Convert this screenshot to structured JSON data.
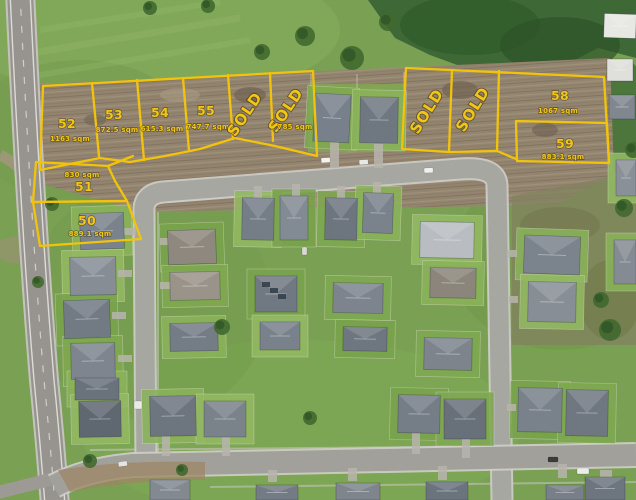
{
  "map": {
    "type": "aerial-subdivision-lot-map",
    "palette": {
      "lot_line": "#F2C30B",
      "lot_text": "#F2C614",
      "grass": "#7AA054",
      "dirt": "#93846F",
      "road": "#A7A7A2",
      "roof": "#78818B"
    },
    "lots": [
      {
        "number": "50",
        "area": "889.1 sqm"
      },
      {
        "number": "51",
        "area": "830 sqm"
      },
      {
        "number": "52",
        "area": "1163 sqm"
      },
      {
        "number": "53",
        "area": "872.5 sqm"
      },
      {
        "number": "54",
        "area": "615.3 sqm"
      },
      {
        "number": "55",
        "area": "747.7 sqm"
      },
      {
        "number": "58",
        "area": "1067 sqm"
      },
      {
        "number": "59",
        "area": "883.1 sqm"
      }
    ],
    "sold_lots": [
      {
        "label": "SOLD"
      },
      {
        "label": "SOLD",
        "area": "785 sqm"
      },
      {
        "label": "SOLD"
      },
      {
        "label": "SOLD"
      }
    ]
  }
}
